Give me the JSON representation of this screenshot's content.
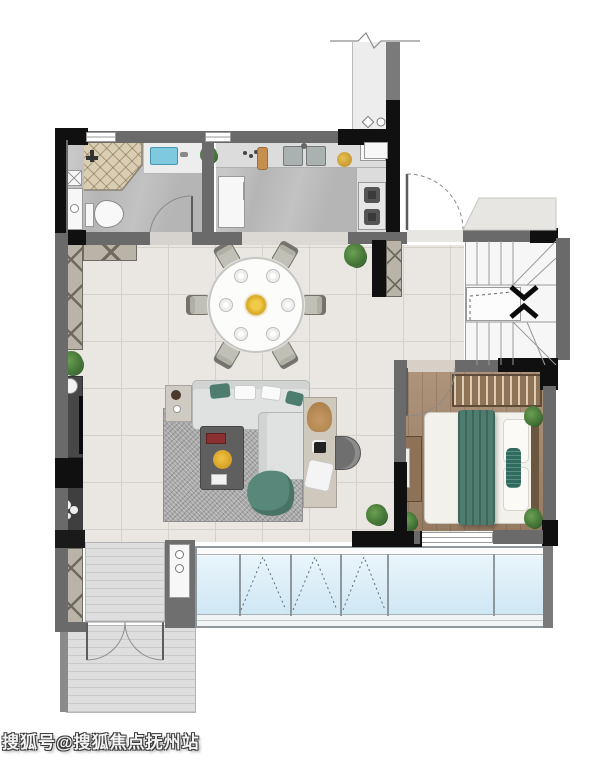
{
  "watermark": {
    "text": "搜狐号@搜狐焦点抚州站"
  },
  "plan": {
    "type": "residential-floorplan",
    "stair_direction_icons": [
      "chevron-down-icon",
      "chevron-up-icon"
    ],
    "palette": {
      "background": "#ffffff",
      "wall": "#6a6a6a",
      "wall_dark": "#101010",
      "tile_floor": "#eae7e2",
      "wet_area_floor": "#b5b5b5",
      "wood_floor": "#a5886c",
      "window_glass": "#d8edf7",
      "teal_textile": "#4e7c6f",
      "rug": "#a9a9a9",
      "balcony_floor": "#dedede",
      "shower_tile": "#d9cdb2",
      "plant": "#4e8243",
      "flower": "#e3b62e"
    }
  }
}
